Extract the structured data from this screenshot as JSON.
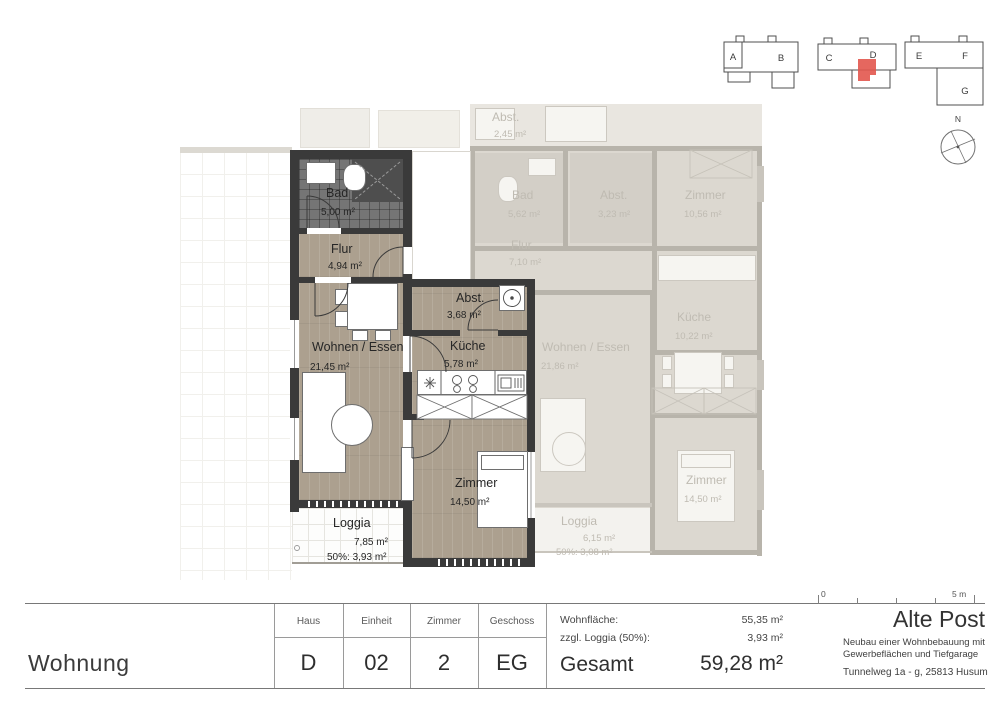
{
  "colors": {
    "wall": "#3a3a3a",
    "wood_floor": "#aca08f",
    "faded": "#bfbbb2",
    "highlight": "#e2564e"
  },
  "key_plan": {
    "labels": {
      "a": "A",
      "b": "B",
      "c": "C",
      "d": "D",
      "e": "E",
      "f": "F",
      "g": "G"
    },
    "north": "N",
    "highlight_color": "#e2564e"
  },
  "plan": {
    "active": {
      "bad": {
        "name": "Bad",
        "area": "5,00 m²"
      },
      "flur": {
        "name": "Flur",
        "area": "4,94 m²"
      },
      "wohnen": {
        "name": "Wohnen / Essen",
        "area": "21,45 m²"
      },
      "abst": {
        "name": "Abst.",
        "area": "3,68 m²"
      },
      "kueche": {
        "name": "Küche",
        "area": "5,78 m²"
      },
      "zimmer": {
        "name": "Zimmer",
        "area": "14,50 m²"
      },
      "loggia": {
        "name": "Loggia",
        "area": "7,85 m²",
        "half": "50%: 3,93 m²"
      }
    },
    "faded": {
      "abst_upper": {
        "name": "Abst.",
        "area": "2,45 m²"
      },
      "bad": {
        "name": "Bad",
        "area": "5,62 m²"
      },
      "abst": {
        "name": "Abst.",
        "area": "3,23 m²"
      },
      "zimmer1": {
        "name": "Zimmer",
        "area": "10,56 m²"
      },
      "flur": {
        "name": "Flur",
        "area": "7,10 m²"
      },
      "kueche": {
        "name": "Küche",
        "area": "10,22 m²"
      },
      "wohnen": {
        "name": "Wohnen / Essen",
        "area": "21,86 m²"
      },
      "zimmer2": {
        "name": "Zimmer",
        "area": "14,50 m²"
      },
      "loggia": {
        "name": "Loggia",
        "area": "6,15 m²",
        "half": "50%: 3,08 m²"
      }
    }
  },
  "scale_bar": {
    "zero": "0",
    "max": "5 m"
  },
  "title_block": {
    "unit_label": "Wohnung",
    "columns": [
      {
        "header": "Haus",
        "value": "D"
      },
      {
        "header": "Einheit",
        "value": "02"
      },
      {
        "header": "Zimmer",
        "value": "2"
      },
      {
        "header": "Geschoss",
        "value": "EG"
      }
    ],
    "areas": {
      "living_label": "Wohnfläche:",
      "living_value": "55,35 m²",
      "loggia_label": "zzgl. Loggia (50%):",
      "loggia_value": "3,93 m²",
      "total_label": "Gesamt",
      "total_value": "59,28 m²"
    },
    "project": {
      "name": "Alte Post",
      "line1": "Neubau einer Wohnbebauung mit",
      "line2": "Gewerbeflächen und Tiefgarage",
      "address": "Tunnelweg 1a - g, 25813 Husum"
    }
  }
}
